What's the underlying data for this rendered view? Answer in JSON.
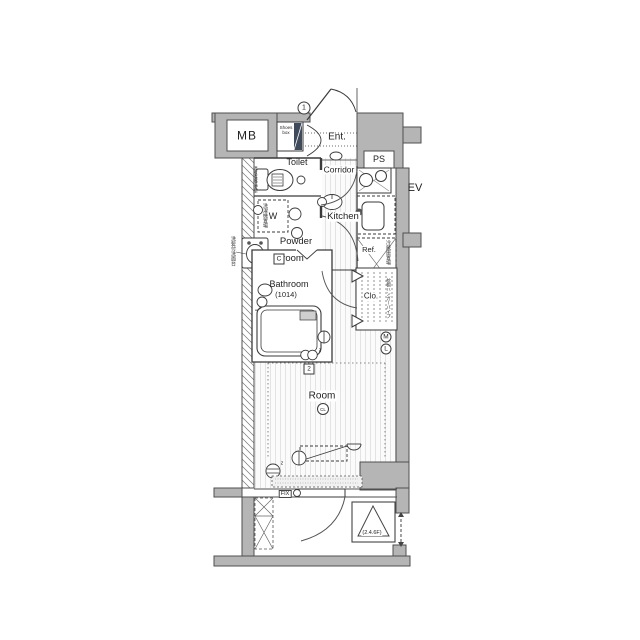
{
  "plan": {
    "rooms": {
      "mb": "MB",
      "shoes_box": "Shoes box",
      "entrance": "Ent.",
      "toilet": "Toilet",
      "corridor": "Corridor",
      "pipe_space": "PS",
      "elevator": "EV",
      "kitchen": "Kitchen",
      "washer": "W",
      "powder_line1": "Powder",
      "powder_line2": "room",
      "bathroom": "Bathroom",
      "bathroom_size": "(1014)",
      "refrigerator": "Ref.",
      "closet": "Clo.",
      "room": "Room",
      "fix_window": "FIX",
      "evacuation_hatch_floors": "(2.4.6F)"
    },
    "symbols": {
      "circled_1": "1",
      "boxed_c": "C",
      "boxed_2": "2",
      "circled_m": "M",
      "circled_l": "L",
      "ceiling_light": "CL",
      "sub_z": "z"
    },
    "notes": {
      "toilet_note": "温水洗浄便座",
      "washer_note": "洗濯機置場",
      "vanity_note": "洗髪付洗面台",
      "fridge_note": "冷蔵庫置場",
      "closet_note": "枕棚ハンガーパイプ"
    },
    "colors": {
      "wall_fill": "#b5b5b5",
      "wall_stroke": "#4f4f4f",
      "line": "#3a3a3a",
      "floor_stripe": "#e3e3e3",
      "shoes_dark": "#3f4a5a"
    }
  }
}
